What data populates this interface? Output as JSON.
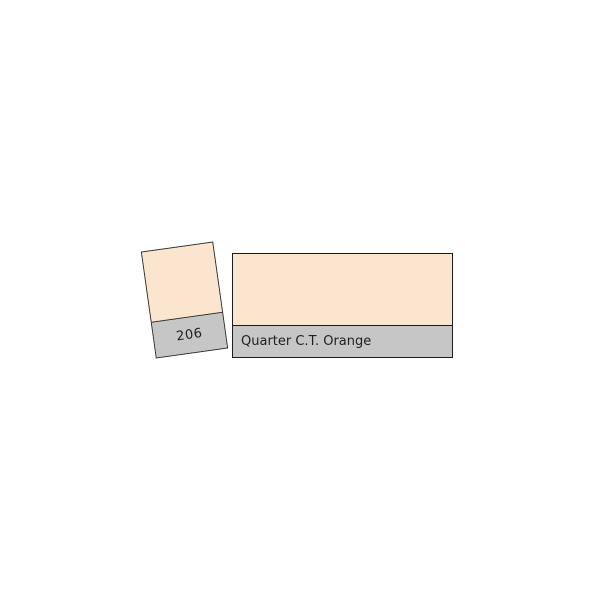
{
  "page": {
    "background_color": "#ffffff"
  },
  "swatch_card": {
    "code": "206",
    "fill_color": "#fce5cf",
    "band_color": "#c6c6c6"
  },
  "filter_panel": {
    "name": "Quarter C.T. Orange",
    "fill_color": "#fce5cf",
    "band_color": "#c6c6c6"
  }
}
